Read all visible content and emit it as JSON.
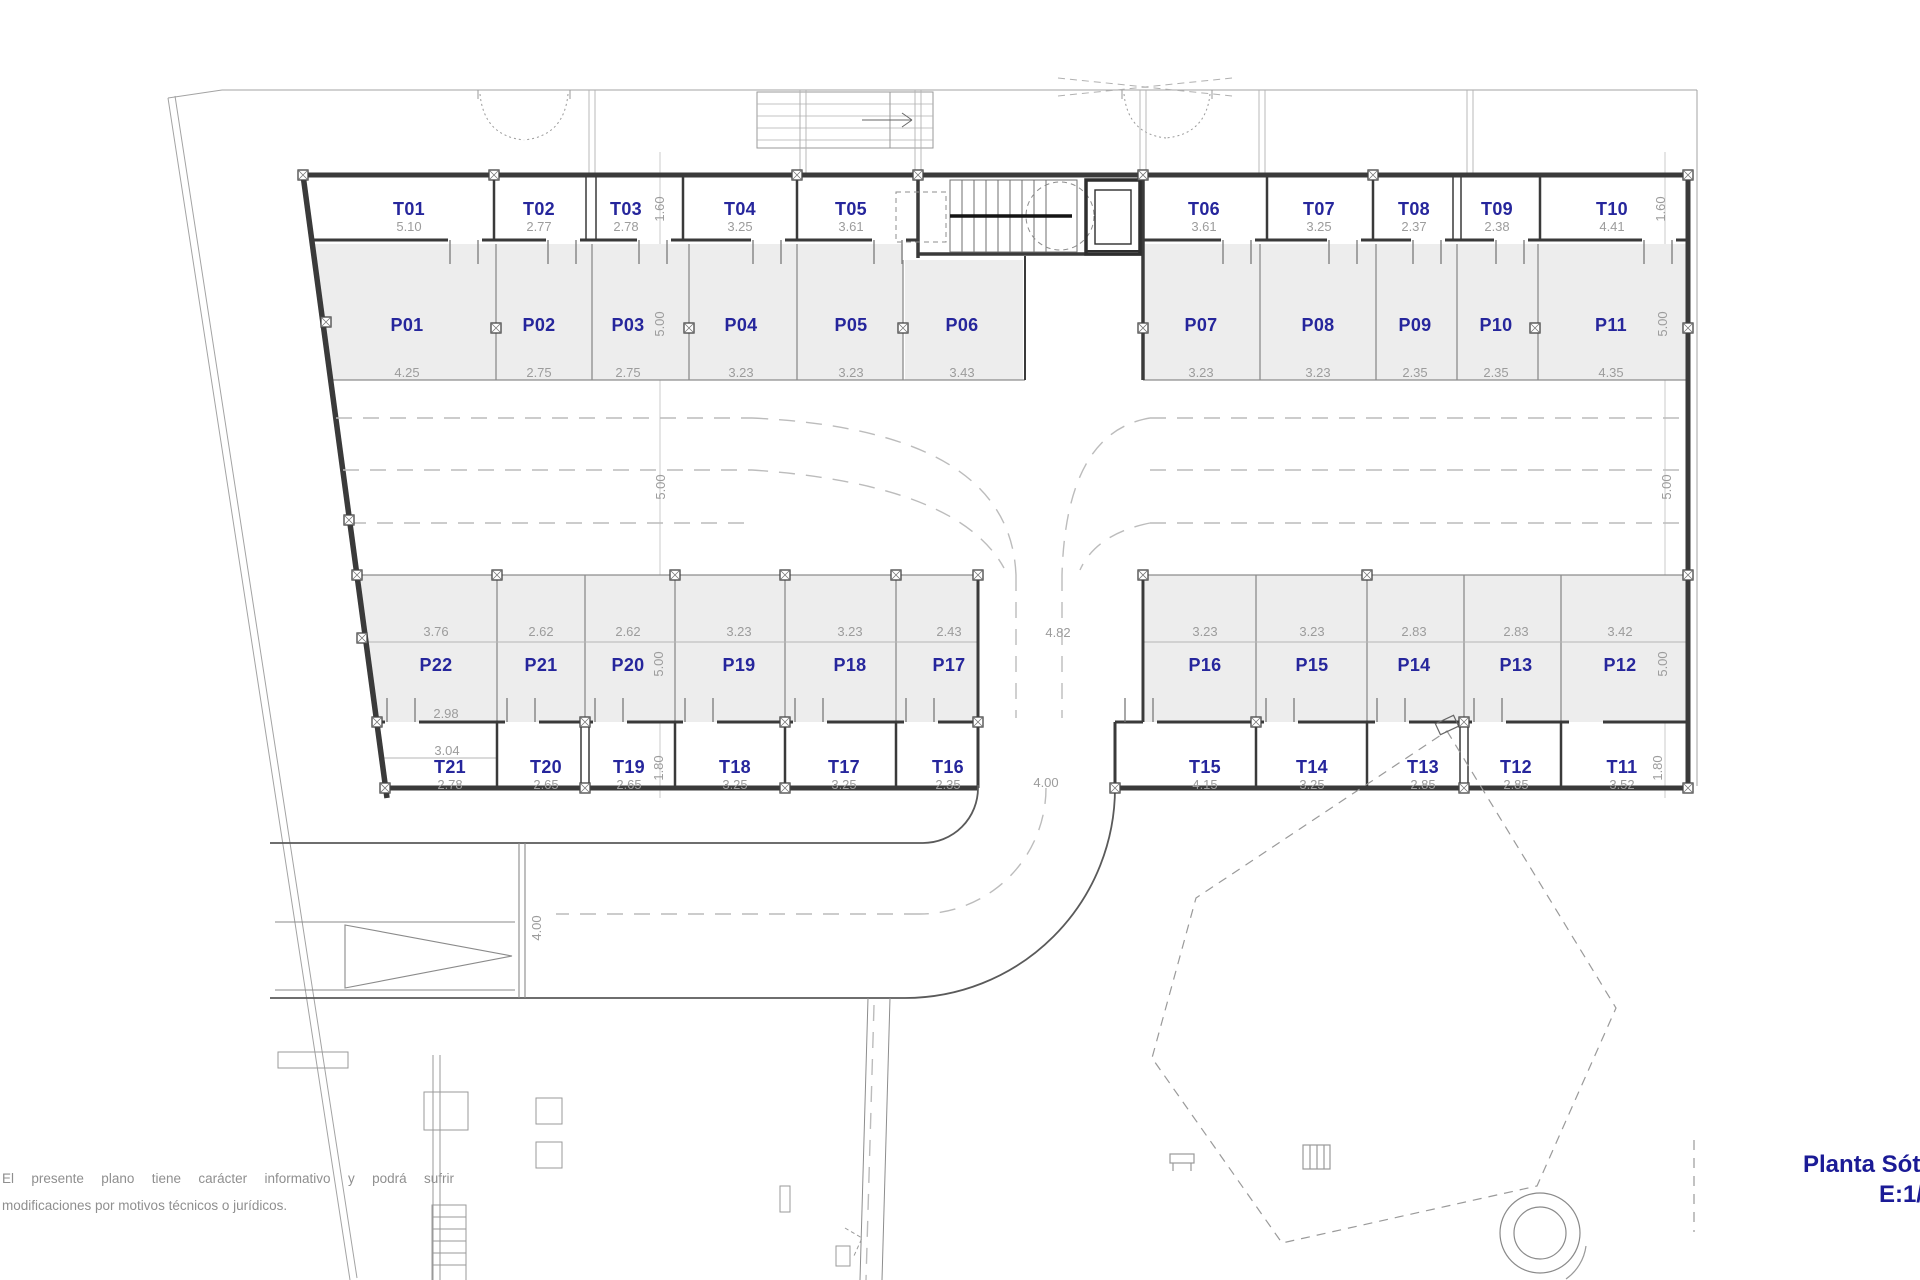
{
  "title": {
    "line1": "Planta Sótano",
    "line2": "E:1/150"
  },
  "disclaimer": {
    "line1": "El presente plano tiene carácter informativo y podrá sufrir",
    "line2": "modificaciones por motivos técnicos o jurídicos."
  },
  "spaces": {
    "top_storage": [
      {
        "id": "T01",
        "dim": "5.10"
      },
      {
        "id": "T02",
        "dim": "2.77"
      },
      {
        "id": "T03",
        "dim": "2.78"
      },
      {
        "id": "T04",
        "dim": "3.25"
      },
      {
        "id": "T05",
        "dim": "3.61"
      },
      {
        "id": "T06",
        "dim": "3.61"
      },
      {
        "id": "T07",
        "dim": "3.25"
      },
      {
        "id": "T08",
        "dim": "2.37"
      },
      {
        "id": "T09",
        "dim": "2.38"
      },
      {
        "id": "T10",
        "dim": "4.41"
      }
    ],
    "top_parking": [
      {
        "id": "P01",
        "dim": "4.25"
      },
      {
        "id": "P02",
        "dim": "2.75"
      },
      {
        "id": "P03",
        "dim": "2.75"
      },
      {
        "id": "P04",
        "dim": "3.23"
      },
      {
        "id": "P05",
        "dim": "3.23"
      },
      {
        "id": "P06",
        "dim": "3.43"
      },
      {
        "id": "P07",
        "dim": "3.23"
      },
      {
        "id": "P08",
        "dim": "3.23"
      },
      {
        "id": "P09",
        "dim": "2.35"
      },
      {
        "id": "P10",
        "dim": "2.35"
      },
      {
        "id": "P11",
        "dim": "4.35"
      }
    ],
    "bottom_parking": [
      {
        "id": "P22",
        "dim": "3.76"
      },
      {
        "id": "P21",
        "dim": "2.62"
      },
      {
        "id": "P20",
        "dim": "2.62"
      },
      {
        "id": "P19",
        "dim": "3.23"
      },
      {
        "id": "P18",
        "dim": "3.23"
      },
      {
        "id": "P17",
        "dim": "2.43"
      },
      {
        "id": "P16",
        "dim": "3.23"
      },
      {
        "id": "P15",
        "dim": "3.23"
      },
      {
        "id": "P14",
        "dim": "2.83"
      },
      {
        "id": "P13",
        "dim": "2.83"
      },
      {
        "id": "P12",
        "dim": "3.42"
      }
    ],
    "bottom_storage": [
      {
        "id": "T21",
        "dim": "2.78"
      },
      {
        "id": "T20",
        "dim": "2.65"
      },
      {
        "id": "T19",
        "dim": "2.65"
      },
      {
        "id": "T18",
        "dim": "3.25"
      },
      {
        "id": "T17",
        "dim": "3.25"
      },
      {
        "id": "T16",
        "dim": "2.35"
      },
      {
        "id": "T15",
        "dim": "4.15"
      },
      {
        "id": "T14",
        "dim": "3.25"
      },
      {
        "id": "T13",
        "dim": "2.85"
      },
      {
        "id": "T12",
        "dim": "2.85"
      },
      {
        "id": "T11",
        "dim": "3.52"
      }
    ]
  },
  "site_dims": {
    "storage_depth_top": "1.60",
    "parking_depth": "5.00",
    "aisle_width": "5.00",
    "storage_depth_bottom": "1.80",
    "exit_width": "4.00",
    "ramp_width": "4.00",
    "mid_gap": "4.82",
    "p22_lower": "2.98",
    "t21_upper": "3.04"
  },
  "colors": {
    "label_blue": "#26269c",
    "dim_gray": "#9c9c9c",
    "stall_fill": "#ededed",
    "wall": "#3a3a3a",
    "title_blue": "#1b1b96"
  }
}
